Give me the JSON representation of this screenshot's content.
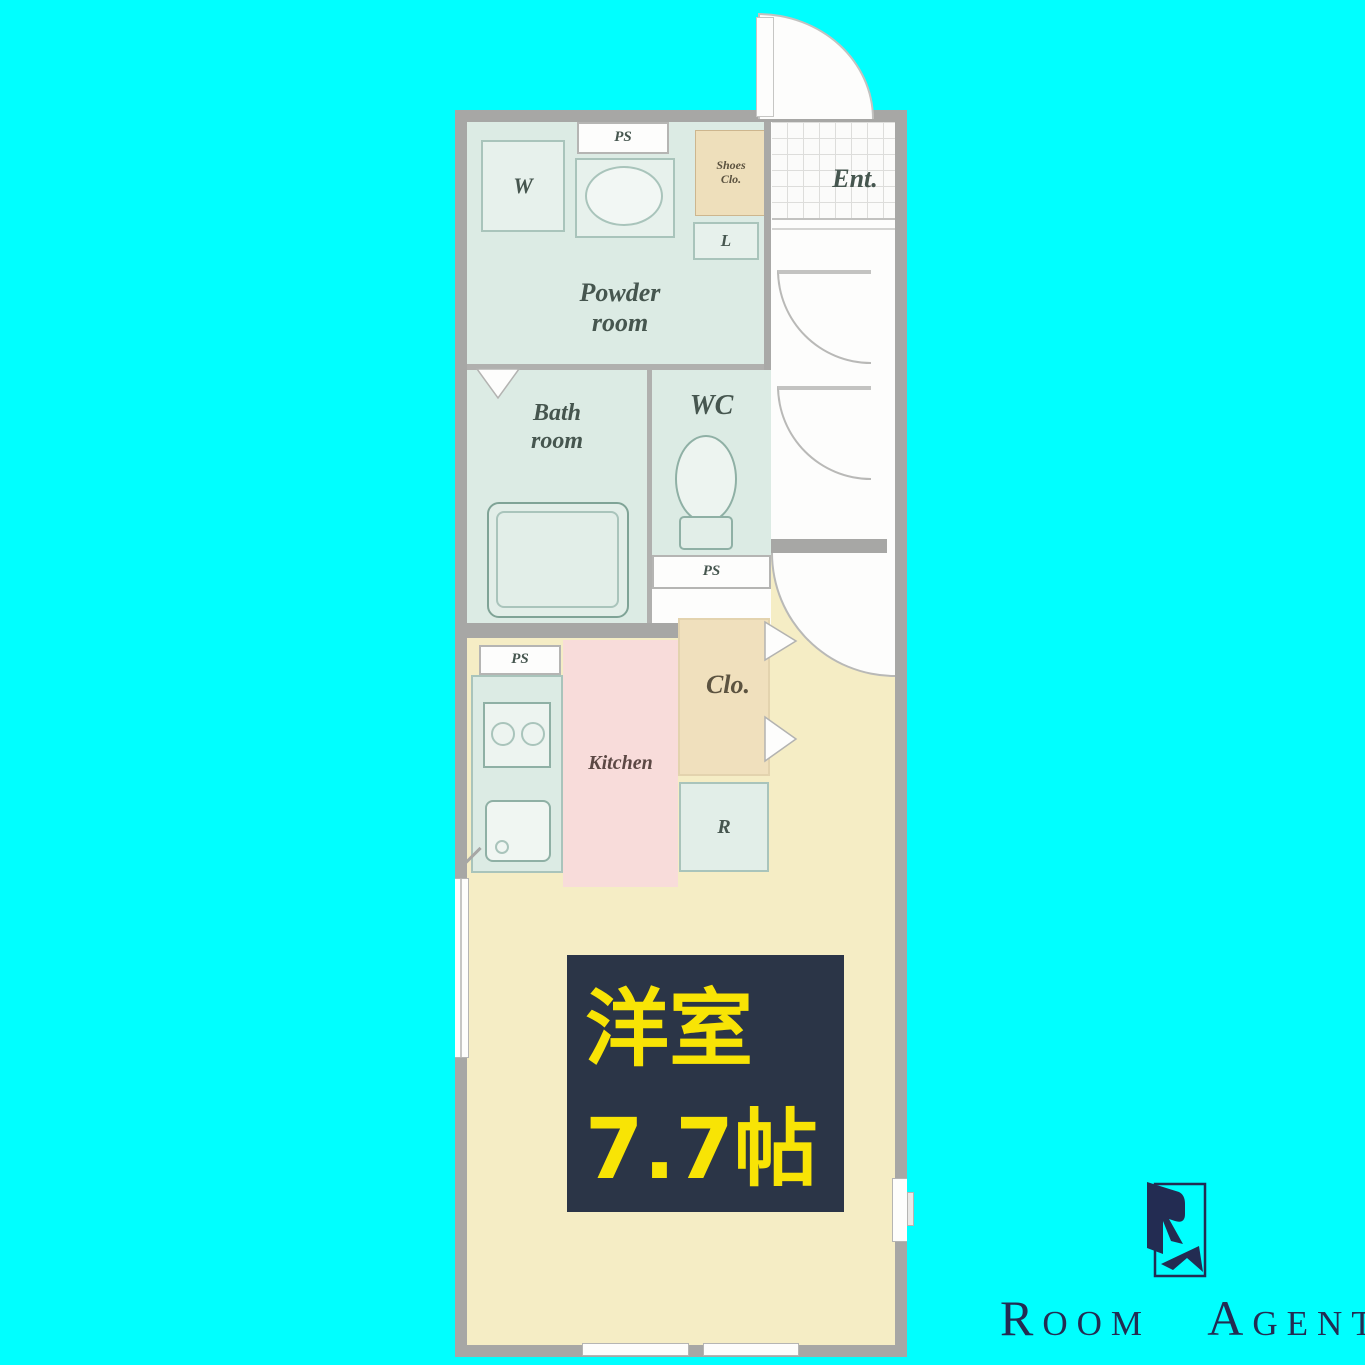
{
  "colors": {
    "background": "#00ffff",
    "wall_gray": "#a7a7a5",
    "wet_room_green": "#dcebe4",
    "closet_beige": "#eedfbb",
    "kitchen_pink": "#f8dcda",
    "main_room_yellow": "#f5edc5",
    "room_label_box": "#2b3547",
    "room_label_text": "#f8e405",
    "logo_navy": "#232c52"
  },
  "plan": {
    "labels": {
      "ps": "PS",
      "washer": "W",
      "shoes_closet_line1": "Shoes",
      "shoes_closet_line2": "Clo.",
      "linen": "L",
      "entrance": "Ent.",
      "powder_line1": "Powder",
      "powder_line2": "room",
      "bath_line1": "Bath",
      "bath_line2": "room",
      "wc": "WC",
      "kitchen": "Kitchen",
      "closet": "Clo.",
      "refrigerator": "R"
    },
    "main_room": {
      "name": "洋室",
      "size": "7.7帖"
    }
  },
  "logo": {
    "word1": "Room",
    "word2": "Agent"
  }
}
